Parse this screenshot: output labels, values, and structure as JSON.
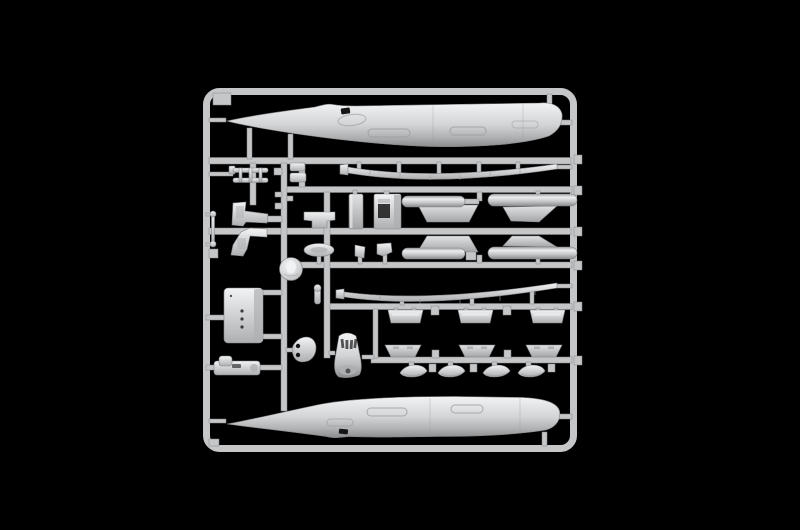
{
  "meta": {
    "type": "photograph",
    "description": "Photograph of a light-gray injection-moulded model kit sprue (parts frame) on a black background. The square runner frame holds two long aircraft fuselage halves (top and bottom), two thin wing strips, two drop tanks with pylons, two cylindrical auxiliary tanks with slanted fin panels, landing-gear legs, seats, an access door panel, a recessed equipment box, a domed fairing, an intake cowling with vents, rows of flap and slat segments, four canoe fairings and assorted small detail parts."
  },
  "colors": {
    "bg": "#000000",
    "runner": "#c4c6c7",
    "runner_edge": "#85878a",
    "part_edge": "#838588",
    "hi": "#f2f3f4",
    "base": "#d3d4d5",
    "mid": "#aeafb1",
    "lo": "#8b8c8e",
    "panel_hi": "#e1e2e3",
    "panel_lo": "#a4a5a7",
    "cyl_dark": "#a6a7a9",
    "cyl_hi": "#ecedee",
    "cyl_mid": "#c7c8c9",
    "hole": "#161617",
    "detail": "#9a9b9d"
  },
  "sprue": {
    "frame_shape": "rounded rectangle runner frame",
    "parts": [
      {
        "id": "fuselage-half-top",
        "label": "fuselage half (upper)",
        "count": 1
      },
      {
        "id": "fuselage-half-bottom",
        "label": "fuselage half (lower)",
        "count": 1
      },
      {
        "id": "wing-strip",
        "label": "long thin wing strip",
        "count": 2
      },
      {
        "id": "seat-rail-ladder",
        "label": "ladder-like seat rails",
        "count": 1
      },
      {
        "id": "landing-gear-leg",
        "label": "angular landing-gear leg",
        "count": 2
      },
      {
        "id": "actuator-rod",
        "label": "thin rod with end knobs",
        "count": 1
      },
      {
        "id": "small-block",
        "label": "small block part",
        "count": 2
      },
      {
        "id": "center-section-tub",
        "label": "notched center-section part",
        "count": 1
      },
      {
        "id": "canoe-blister",
        "label": "lens-shaped blister",
        "count": 1
      },
      {
        "id": "equipment-box",
        "label": "box with recessed opening",
        "count": 1
      },
      {
        "id": "bulkhead-panel",
        "label": "tall rectangular bulkhead",
        "count": 1
      },
      {
        "id": "wedge-bracket",
        "label": "small wedge bracket",
        "count": 2
      },
      {
        "id": "drop-tank",
        "label": "drop tank with pylon",
        "count": 2
      },
      {
        "id": "auxiliary-cylinder",
        "label": "cylindrical auxiliary tank",
        "count": 2
      },
      {
        "id": "tank-fin",
        "label": "slanted fin panel",
        "count": 2
      },
      {
        "id": "wheel-disc",
        "label": "round hub disc with dome",
        "count": 1
      },
      {
        "id": "access-door",
        "label": "door panel with rivet holes",
        "count": 1
      },
      {
        "id": "crew-seat",
        "label": "crew seat on its side",
        "count": 1
      },
      {
        "id": "dome-fairing",
        "label": "dome fairing with two holes",
        "count": 1
      },
      {
        "id": "intake-cowling",
        "label": "intake cowling with vent slots",
        "count": 1
      },
      {
        "id": "flap-segment",
        "label": "flap segment",
        "count": 3
      },
      {
        "id": "slat-segment",
        "label": "slat segment",
        "count": 3
      },
      {
        "id": "fairing-canoe",
        "label": "canoe fairing",
        "count": 4
      },
      {
        "id": "small-pin",
        "label": "small pin part",
        "count": 1
      }
    ]
  }
}
